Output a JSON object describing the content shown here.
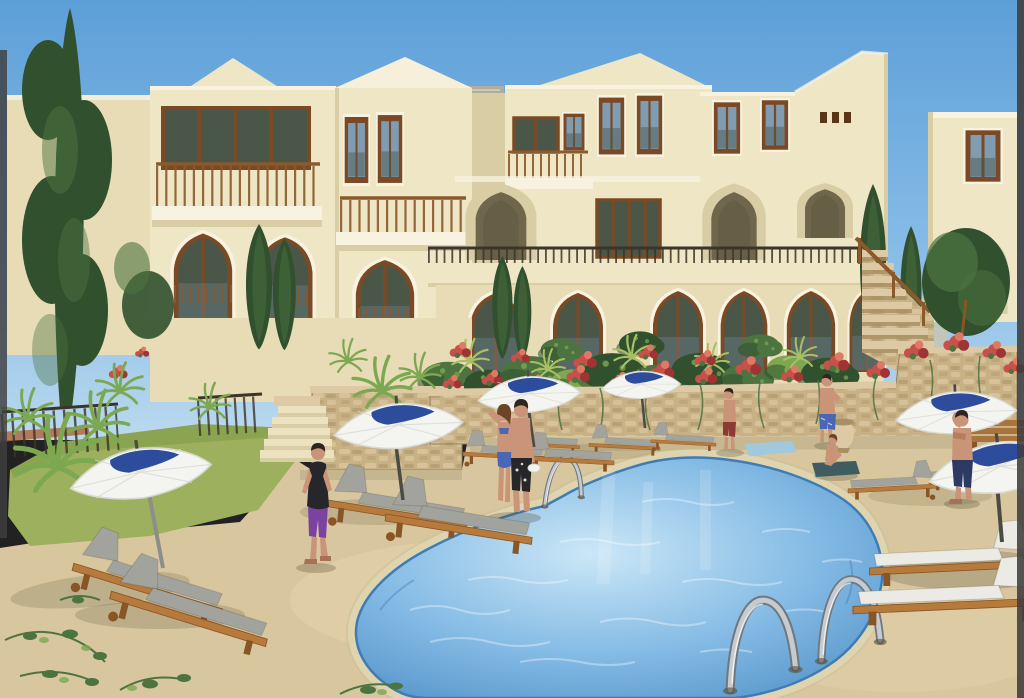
{
  "scene": {
    "type": "3d-architectural-rendering",
    "setting": "Mediterranean resort of cream stucco villas with pointed Moorish arches, timber balconies and a communal kidney-shaped swimming pool",
    "sky": "clear blue sky",
    "buildings": {
      "style": "two and three storey cream stucco villas",
      "features": "pointed arch windows and porticos, brown timber window frames, wooden balcony railings, dark metal terrace railing, white trim, flat and hipped roofs"
    },
    "pool": {
      "shape": "kidney",
      "water": "light blue with ripple highlights",
      "ladders": 3,
      "coping": "cream stone rim"
    },
    "deck": "sand coloured terrace",
    "lawn": "green grass strip on the left",
    "walls": "sandstone retaining walls draped with red bougainvillea and hanging vines",
    "stairs": "stone staircase with timber handrail on the right, small stone steps on the left",
    "umbrella_count": 6,
    "umbrella_style": "white parasol with navy blue swoosh motif",
    "lounger_count": 13,
    "lounger_style": "timber sun loungers with grey or white cushions",
    "bench_count": 1,
    "urn_count": 1,
    "towels": [
      "light blue towel on deck",
      "dark teal towel under sitting woman"
    ],
    "vegetation": [
      "tall dark poplar tree far left",
      "cypress trees",
      "yucca and palm shrubs",
      "round clipped bushes",
      "red and pink bougainvillea",
      "creeping vines on the deck corner"
    ],
    "people": [
      {
        "id": "boy-walking",
        "desc": "boy in black vest and purple shorts walking toward pool, left side"
      },
      {
        "id": "woman-couple",
        "desc": "woman in blue bikini standing by pool, hand raised to hair"
      },
      {
        "id": "man-couple",
        "desc": "man in dark patterned swim shorts holding white hat beside her"
      },
      {
        "id": "man-maroon",
        "desc": "man in maroon shorts standing by flower wall across the pool"
      },
      {
        "id": "man-blue-trunks",
        "desc": "man in blue trunks standing near stone urn"
      },
      {
        "id": "woman-sitting",
        "desc": "woman sitting on dark towel near urn"
      },
      {
        "id": "man-navy",
        "desc": "man in navy swim shorts standing under right umbrellas, arm raised"
      }
    ]
  },
  "colors": {
    "skyTop": "#5d9fd8",
    "skyMid": "#85bbe6",
    "skyLow": "#bad9ee",
    "hazyHill": "#d3c5a0",
    "wallLit": "#efe6c6",
    "wallWarm": "#e7dcb6",
    "wallShade": "#d9cda6",
    "wallDark": "#c8ba92",
    "trimWhite": "#f8f3e0",
    "roofGray": "#b3ac9a",
    "roofEdge": "#d8d2bc",
    "frameBrown": "#7a4a26",
    "frameDark": "#5a3517",
    "glass": "#7f9cb2",
    "glassDark": "#4a5648",
    "glassPale": "#a9c3d2",
    "archDeep": "#70664c",
    "stone": "#c9b186",
    "stoneLight": "#ddcaa4",
    "stoneDark": "#a88f64",
    "stoneLine": "#97805c",
    "flowerRed": "#c8504a",
    "flowerDeep": "#9e3434",
    "flowerPink": "#de7a64",
    "leafDark": "#31502e",
    "leafMid": "#4d7340",
    "leafBright": "#7ca851",
    "leafYellow": "#a9bf63",
    "grass": "#9cb05e",
    "grassDark": "#7e9a49",
    "deck": "#d8c79e",
    "deckLight": "#e7d8b1",
    "deckShade": "#c2af86",
    "coping": "#ece2c0",
    "copingEdge": "#c6b98e",
    "poolEdge": "#4f8fc6",
    "poolMid": "#83bae4",
    "poolPale": "#cbe7f7",
    "poolLine": "#3f7cb4",
    "chrome": "#c6cbd0",
    "chromeDark": "#70787e",
    "umbWhite": "#f4f4f0",
    "umbShade": "#d7d8d0",
    "umbNavy": "#2e4c9c",
    "umbPole": "#8e8e88",
    "umbPoleDark": "#4b4b46",
    "woodLit": "#b57a3c",
    "woodDark": "#8a5526",
    "cushionGray": "#a3a39e",
    "cushionWhite": "#eceae4",
    "skin": "#c99478",
    "skinShade": "#a87054",
    "hairDark": "#2d2620",
    "hairBrown": "#6b4526",
    "clothBlack": "#27262a",
    "clothPurple": "#7c42a0",
    "clothNavy": "#2c3a64",
    "clothBikini": "#4c66b6",
    "clothMaroon": "#8e3a34",
    "towelBlue": "#a2c8de",
    "towelDark": "#3f5c60",
    "railWood": "#8a592c",
    "railDark": "#3b342a",
    "benchWood": "#a8743c",
    "terracotta": "#b06a42",
    "shadow": "#55503c",
    "edgeDark": "#3e3e3e",
    "white": "#ffffff"
  }
}
